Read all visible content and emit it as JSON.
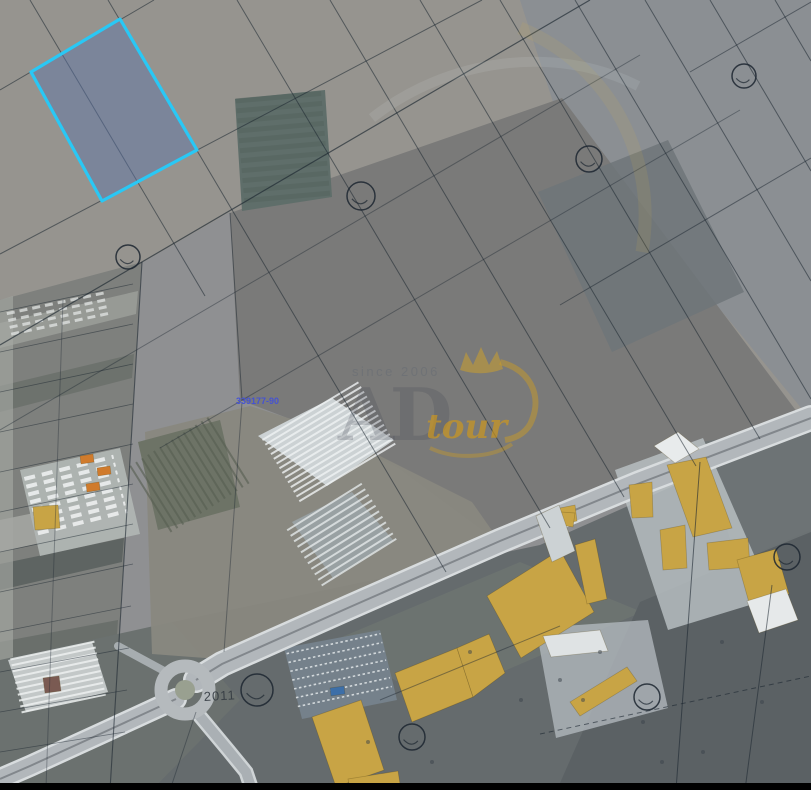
{
  "map": {
    "width": 811,
    "height": 790,
    "colors": {
      "base": "#8f9092",
      "cadastral_line": "#1c2630",
      "selection_stroke": "#29c8f5",
      "selection_fill": "#5a73a8",
      "building_yellow": "#c8a445",
      "building_white": "#e8ebec",
      "road_fill": "#b2b7bb",
      "watermark_gold": "#ce981c",
      "label_blue": "#4250d8",
      "letterbox": "#010101"
    },
    "labels": {
      "parcel_id": "339177-90",
      "road_number": "2011"
    },
    "watermark": {
      "since": "since 2006",
      "brand": "AD",
      "suffix": "tour"
    },
    "regions": [
      {
        "name": "field-top-left",
        "pts": "0,0 811,0 811,418 230,212 0,345",
        "fill": "#96948f",
        "op": 1
      },
      {
        "name": "field-top-right",
        "pts": "520,0 811,0 811,420 555,108",
        "fill": "#8a8e93",
        "op": 0.95
      },
      {
        "name": "field-central-dark",
        "pts": "230,213 562,98 806,424 640,484 498,542 398,468 298,422 240,400",
        "fill": "#7a7a79",
        "op": 1
      },
      {
        "name": "field-central-patch",
        "pts": "538,192 668,140 744,292 612,352",
        "fill": "#6f7679",
        "op": 0.85
      },
      {
        "name": "plot-striped-green",
        "pts": "235,99 325,90 332,197 242,211",
        "fill": "#5f6e6a",
        "op": 1
      },
      {
        "name": "band-left-smallholdings",
        "pts": "0,300 142,262 110,790 0,790",
        "fill": "#7e807d",
        "op": 1
      },
      {
        "name": "strip-light-1",
        "pts": "0,323 138,291 136,314 0,348",
        "fill": "#9a9c98",
        "op": 0.9
      },
      {
        "name": "strip-dark-1",
        "pts": "0,386 134,354 132,378 0,412",
        "fill": "#6c706c",
        "op": 0.9
      },
      {
        "name": "strip-light-2",
        "pts": "0,520 126,494 124,524 0,552",
        "fill": "#a0a29e",
        "op": 1
      },
      {
        "name": "strip-dark-2",
        "pts": "0,564 124,538 122,562 0,590",
        "fill": "#5e6462",
        "op": 1
      },
      {
        "name": "strip-dark-3",
        "pts": "0,642 118,620 116,652 0,676",
        "fill": "#686d69",
        "op": 0.9
      },
      {
        "name": "edge-strip",
        "pts": "0,300 13,296 13,790 0,790",
        "fill": "#a5a7a3",
        "op": 0.65
      },
      {
        "name": "field-bottom",
        "pts": "0,662 172,622 540,545 811,425 811,783 0,783",
        "fill": "#656b6d",
        "op": 1
      },
      {
        "name": "patch-bottom-left",
        "pts": "0,660 172,622 240,700 152,790 0,790",
        "fill": "#6b716f",
        "op": 1
      },
      {
        "name": "patch-left-of-road",
        "pts": "145,432 250,406 332,432 472,502 500,542 232,660 152,654",
        "fill": "#89887f",
        "op": 0.95
      },
      {
        "name": "orchard",
        "pts": "138,442 220,420 240,507 158,530",
        "fill": "#6d7366",
        "op": 1
      },
      {
        "name": "patch-bottom-mid",
        "pts": "330,642 520,562 642,612 432,702",
        "fill": "#6d7471",
        "op": 0.85
      },
      {
        "name": "patch-bottom-right-dark",
        "pts": "640,602 811,530 811,783 560,783",
        "fill": "#5b6164",
        "op": 1
      },
      {
        "name": "patch-right-mid",
        "pts": "700,442 811,426 811,532 737,562",
        "fill": "#6e7476",
        "op": 0.9
      },
      {
        "name": "yard-industrial-east",
        "pts": "615,470 703,438 773,598 668,630",
        "fill": "#bcc3c6",
        "op": 0.8
      },
      {
        "name": "yard-industrial-south",
        "pts": "536,628 648,620 668,708 556,738",
        "fill": "#b5bcc1",
        "op": 0.75
      },
      {
        "name": "yard-truck-depot",
        "pts": "20,470 120,448 140,534 40,556",
        "fill": "#b0b5b3",
        "op": 0.95
      },
      {
        "name": "parking-lot",
        "pts": "284,648 380,630 397,700 302,719",
        "fill": "#75818b",
        "op": 1
      },
      {
        "name": "greenhouse-block-1",
        "pts": "258,436 332,398 394,440 327,486",
        "fill": "#ccd2d4",
        "op": 1
      },
      {
        "name": "greenhouse-block-2",
        "pts": "292,522 352,492 393,540 333,578",
        "fill": "#99a1a3",
        "op": 1
      },
      {
        "name": "greenhouse-block-3",
        "pts": "8,660 92,642 108,692 26,712",
        "fill": "#c3c8c8",
        "op": 1
      }
    ],
    "roads": [
      {
        "name": "main-road",
        "pts": "811,418 640,483 500,541 350,607 222,664 196,680",
        "w": 21,
        "fill": "#b2b7bb",
        "edge": "#d8dcde",
        "median": "#7c8287"
      },
      {
        "name": "main-road-sw",
        "pts": "176,699 100,734 30,766 0,779",
        "w": 17,
        "fill": "#b2b7bb",
        "edge": "#d8dcde",
        "median": "#7c8287"
      },
      {
        "name": "south-road",
        "pts": "198,714 228,750 246,772 252,790",
        "w": 10,
        "fill": "#aab0b4",
        "edge": "#cfd4d6"
      },
      {
        "name": "west-spur",
        "pts": "166,672 118,646",
        "w": 8,
        "fill": "#a7adb0"
      }
    ],
    "roundabout": {
      "cx": 185,
      "cy": 690,
      "ring_r": 24,
      "ring_w": 13,
      "ring_color": "#b5babd",
      "island_r": 10,
      "island_color": "#99a090"
    },
    "hatches": [
      {
        "name": "plot-stripes",
        "cx": 283,
        "cy": 150,
        "w": 86,
        "h": 106,
        "rot": -5,
        "gap": 10,
        "lw": 5,
        "color": "#55645f",
        "op": 0.55
      },
      {
        "name": "greenhouse-1-rows",
        "cx": 329,
        "cy": 442,
        "w": 112,
        "h": 72,
        "rot": -31,
        "gap": 5.5,
        "lw": 2,
        "color": "#f0f3f4",
        "op": 0.8
      },
      {
        "name": "greenhouse-2-rows",
        "cx": 342,
        "cy": 535,
        "w": 88,
        "h": 66,
        "rot": -32,
        "gap": 6.5,
        "lw": 2,
        "color": "#e4e9ea",
        "op": 0.8
      },
      {
        "name": "greenhouse-3-rows",
        "cx": 58,
        "cy": 677,
        "w": 86,
        "h": 54,
        "rot": -12,
        "gap": 6,
        "lw": 2,
        "color": "#eef1f1",
        "op": 0.85
      },
      {
        "name": "orchard-rows",
        "cx": 189,
        "cy": 475,
        "w": 78,
        "h": 92,
        "rot": 58,
        "gap": 7,
        "lw": 2,
        "color": "#565e51",
        "op": 0.6
      },
      {
        "name": "parking-rows",
        "cx": 340,
        "cy": 674,
        "w": 96,
        "h": 62,
        "rot": -12,
        "gap": 9,
        "lw": 1.6,
        "color": "#dde2e4",
        "dash": "2.5,2.5",
        "op": 0.9
      },
      {
        "name": "depot-truck-rows",
        "cx": 76,
        "cy": 496,
        "w": 92,
        "h": 58,
        "rot": -14,
        "gap": 8,
        "lw": 4,
        "color": "#f1f3f3",
        "dash": "11,7",
        "op": 0.85
      },
      {
        "name": "smallholding-rows",
        "cx": 58,
        "cy": 314,
        "w": 100,
        "h": 22,
        "rot": -12,
        "gap": 7,
        "lw": 3,
        "color": "#e8ebea",
        "dash": "8,5",
        "op": 0.7
      }
    ],
    "buildings": [
      {
        "name": "warehouse-ne-small",
        "pts": "629,485 652,482 653,517 632,518",
        "fill": "#c8a445"
      },
      {
        "name": "warehouse-ne-big",
        "pts": "667,465 706,457 732,528 693,537",
        "fill": "#c8a445"
      },
      {
        "name": "warehouse-ne-mid",
        "pts": "660,530 685,525 687,568 663,570",
        "fill": "#c8a445"
      },
      {
        "name": "warehouse-east-1",
        "pts": "707,543 748,538 750,567 709,570",
        "fill": "#c8a445"
      },
      {
        "name": "warehouse-east-2",
        "pts": "737,560 776,549 789,594 750,606",
        "fill": "#c8a445"
      },
      {
        "name": "warehouse-center-big",
        "pts": "487,596 560,550 594,612 521,658",
        "fill": "#c8a445"
      },
      {
        "name": "warehouse-center-strip",
        "pts": "575,545 595,539 607,599 587,604",
        "fill": "#c8a445"
      },
      {
        "name": "shed-center-small",
        "pts": "560,508 575,505 577,521 562,524",
        "fill": "#c8a445"
      },
      {
        "name": "shed-center-tiny",
        "pts": "561,512 575,513 573,527 560,525",
        "fill": "#c8a445"
      },
      {
        "name": "warehouse-south-big",
        "pts": "312,717 361,700 384,770 336,787",
        "fill": "#c8a445"
      },
      {
        "name": "warehouse-south-twin-1",
        "pts": "395,673 457,648 473,697 412,722",
        "fill": "#c8a445"
      },
      {
        "name": "warehouse-south-twin-2",
        "pts": "457,648 489,634 505,673 473,697",
        "fill": "#c8a445"
      },
      {
        "name": "shed-south-edge",
        "pts": "348,779 398,771 401,790 350,790",
        "fill": "#c8a445"
      },
      {
        "name": "warehouse-se-long",
        "pts": "570,702 627,667 637,681 580,716",
        "fill": "#c8a445"
      },
      {
        "name": "depot-building",
        "pts": "33,507 58,505 60,528 35,530",
        "fill": "#c8a445"
      },
      {
        "name": "building-white-roadside",
        "pts": "654,446 678,432 699,449 675,463",
        "fill": "#e8ebec"
      },
      {
        "name": "building-white-se",
        "pts": "747,601 786,589 798,620 759,633",
        "fill": "#e6e9ea"
      },
      {
        "name": "building-white-south",
        "pts": "543,636 600,630 608,651 551,657",
        "fill": "#dfe3e4"
      },
      {
        "name": "building-white-center",
        "pts": "536,516 559,505 575,551 552,562",
        "fill": "#ccd2d4"
      },
      {
        "name": "truck-orange-1",
        "pts": "80,456 93,454 94,462 81,464",
        "fill": "#d07b2c"
      },
      {
        "name": "truck-orange-2",
        "pts": "97,468 110,466 111,474 98,476",
        "fill": "#d07b2c"
      },
      {
        "name": "truck-orange-3",
        "pts": "86,484 99,482 100,490 87,492",
        "fill": "#d07b2c"
      },
      {
        "name": "vehicle-blue",
        "pts": "330,688 344,686 345,694 331,696",
        "fill": "#3d6fa8"
      },
      {
        "name": "shed-red-roof",
        "pts": "43,678 59,676 61,691 45,693",
        "fill": "#7a5a52"
      }
    ],
    "boundary_lines": [
      {
        "pts": "108,0 446,572"
      },
      {
        "pts": "237,0 550,528"
      },
      {
        "pts": "330,0 624,497"
      },
      {
        "pts": "420,0 696,466"
      },
      {
        "pts": "500,0 760,439"
      },
      {
        "pts": "575,0 811,399"
      },
      {
        "pts": "645,0 811,281"
      },
      {
        "pts": "710,0 811,171"
      },
      {
        "pts": "775,0 811,61"
      },
      {
        "pts": "30,0 205,296"
      },
      {
        "pts": "0,90 154,0"
      },
      {
        "pts": "0,254 482,0"
      },
      {
        "pts": "0,345 590,0",
        "w": 1.2,
        "op": 0.65
      },
      {
        "pts": "0,430 640,55",
        "op": 0.4
      },
      {
        "pts": "160,448 740,110",
        "op": 0.4
      },
      {
        "pts": "560,305 811,158",
        "op": 0.5
      },
      {
        "pts": "690,72 811,2",
        "op": 0.5
      },
      {
        "pts": "0,312 133,284",
        "op": 0.5,
        "w": 0.8
      },
      {
        "pts": "0,352 133,324",
        "op": 0.5,
        "w": 0.8
      },
      {
        "pts": "0,392 133,364",
        "op": 0.5,
        "w": 0.8
      },
      {
        "pts": "0,432 133,404",
        "op": 0.5,
        "w": 0.8
      },
      {
        "pts": "0,472 133,444",
        "op": 0.5,
        "w": 0.8
      },
      {
        "pts": "0,512 133,484",
        "op": 0.5,
        "w": 0.8
      },
      {
        "pts": "0,552 133,524",
        "op": 0.5,
        "w": 0.8
      },
      {
        "pts": "0,592 133,564",
        "op": 0.5,
        "w": 0.8
      },
      {
        "pts": "0,632 131,606",
        "op": 0.5,
        "w": 0.8
      },
      {
        "pts": "0,672 129,648",
        "op": 0.5,
        "w": 0.8
      },
      {
        "pts": "0,712 127,690",
        "op": 0.5,
        "w": 0.8
      },
      {
        "pts": "0,752 125,732",
        "op": 0.5,
        "w": 0.8
      },
      {
        "pts": "142,262 110,790",
        "w": 1.1,
        "op": 0.6
      },
      {
        "pts": "63,300 46,788",
        "op": 0.35
      },
      {
        "pts": "230,213 242,400",
        "op": 0.5
      },
      {
        "pts": "242,402 224,652",
        "op": 0.4
      },
      {
        "pts": "700,462 676,790",
        "op": 0.6
      },
      {
        "pts": "772,585 745,790",
        "op": 0.55
      },
      {
        "pts": "540,734 811,676",
        "dash": true,
        "op": 0.6
      },
      {
        "pts": "380,700 560,626",
        "op": 0.45
      },
      {
        "pts": "196,712 170,790",
        "op": 0.4
      }
    ],
    "symbol_circles": [
      {
        "cx": 128,
        "cy": 257,
        "r": 12
      },
      {
        "cx": 361,
        "cy": 196,
        "r": 14
      },
      {
        "cx": 589,
        "cy": 159,
        "r": 13
      },
      {
        "cx": 744,
        "cy": 76,
        "r": 12
      },
      {
        "cx": 787,
        "cy": 557,
        "r": 13
      },
      {
        "cx": 647,
        "cy": 697,
        "r": 13
      },
      {
        "cx": 412,
        "cy": 737,
        "r": 13
      },
      {
        "cx": 257,
        "cy": 690,
        "r": 16
      }
    ],
    "veg_dots": [
      [
        600,
        652
      ],
      [
        643,
        722
      ],
      [
        703,
        752
      ],
      [
        583,
        700
      ],
      [
        762,
        702
      ],
      [
        722,
        642
      ],
      [
        662,
        762
      ],
      [
        432,
        762
      ],
      [
        521,
        700
      ],
      [
        368,
        742
      ],
      [
        470,
        652
      ],
      [
        560,
        680
      ]
    ],
    "highlight_parcel": {
      "pts": "120,19 197,150 102,201 31,72",
      "fill": "#5a73a8",
      "fill_opacity": 0.45,
      "stroke": "#29c8f5",
      "stroke_width": 3.2
    }
  }
}
